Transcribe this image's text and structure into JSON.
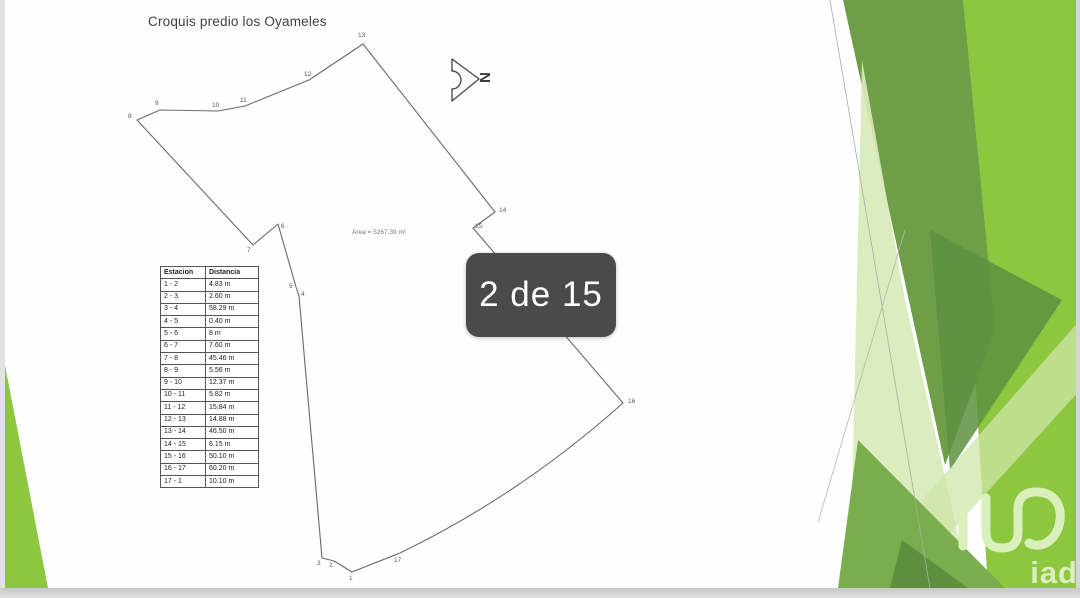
{
  "slide": {
    "title": "Croquis predio los Oyameles",
    "area_label": "Area = 5267.39 m²",
    "north_label": "N"
  },
  "overlay": {
    "counter": "2 de 15"
  },
  "table": {
    "headers": [
      "Estacion",
      "Distancia"
    ],
    "rows": [
      {
        "station": "1 - 2",
        "distance": "4.83 m"
      },
      {
        "station": "2 - 3",
        "distance": "2.60 m"
      },
      {
        "station": "3 - 4",
        "distance": "58.29 m"
      },
      {
        "station": "4 - 5",
        "distance": "0.40 m"
      },
      {
        "station": "5 - 6",
        "distance": "8 m"
      },
      {
        "station": "6 - 7",
        "distance": "7.60 m"
      },
      {
        "station": "7 - 8",
        "distance": "45.46 m"
      },
      {
        "station": "8 - 9",
        "distance": "5.56 m"
      },
      {
        "station": "9 - 10",
        "distance": "12.37 m"
      },
      {
        "station": "10 - 11",
        "distance": "5.82 m"
      },
      {
        "station": "11 - 12",
        "distance": "15.84 m"
      },
      {
        "station": "12 - 13",
        "distance": "14.88 m"
      },
      {
        "station": "13 - 14",
        "distance": "46.50 m"
      },
      {
        "station": "14 - 15",
        "distance": "6.15 m"
      },
      {
        "station": "15 - 16",
        "distance": "50.10 m"
      },
      {
        "station": "16 - 17",
        "distance": "60.20 m"
      },
      {
        "station": "17 - 1",
        "distance": "10.10 m"
      }
    ]
  },
  "plot": {
    "vertex_labels": [
      "1",
      "2",
      "3",
      "4",
      "5",
      "6",
      "7",
      "8",
      "9",
      "10",
      "11",
      "12",
      "13",
      "14",
      "15",
      "16",
      "17"
    ]
  },
  "logo": {
    "brand": "iad"
  },
  "colors": {
    "badge_bg": "#4a4a4a",
    "green_bright": "#8dc63f",
    "green_olive": "#6f9e49",
    "green_pale": "#d8eab9",
    "line_gray": "#6a6a6a"
  }
}
